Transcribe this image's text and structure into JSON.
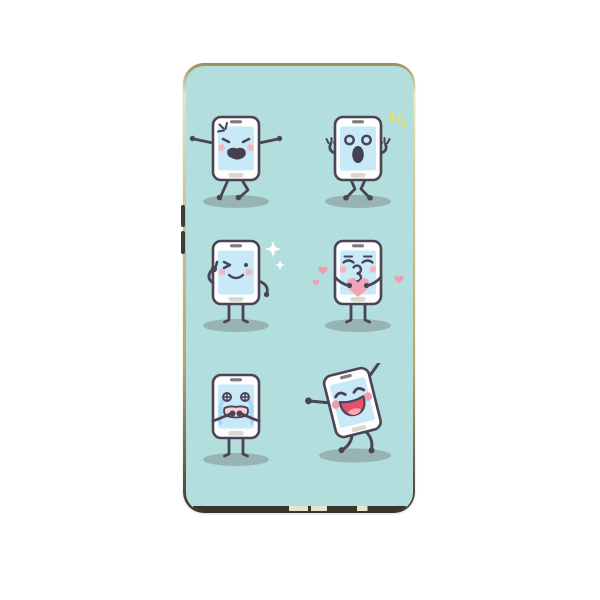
{
  "product": {
    "type": "phone-case",
    "description": "Phone case product photo: gold metal frame, teal back printed with six cartoon smartphone emoji characters in a 2x3 grid",
    "pattern_grid": "2 columns x 3 rows"
  },
  "colors": {
    "background": "#ffffff",
    "case_teal": "#b2dede",
    "outline": "#4a4454",
    "body": "#fdfdfd",
    "screen": "#c7e9f8",
    "speaker": "#7d7d7d",
    "home": "#d9d9d0",
    "cheek": "#f4b6c2",
    "cheek_deep": "#f29cae",
    "mouth": "#453f4e",
    "mouth_red": "#e25069",
    "tongue": "#f7a6b4",
    "heart": "#f2a3b4",
    "heart_small": "#f09cae",
    "tear": "#a9d9f2",
    "sparkle_yellow": "#f0de55",
    "sparkle_white": "#ffffff",
    "shadow": "rgba(110,110,110,0.38)",
    "port_bar": "#3a342c",
    "port_cut": "#e9e2cc",
    "button": "#3f3a33"
  },
  "characters": [
    {
      "id": "angry-phone",
      "grid": "row1-col1",
      "emotion": "angry",
      "features": [
        "anger-mark",
        "slanted-angry-eyes",
        "open-shouting-mouth",
        "blush-cheeks",
        "arms-stretched-out",
        "walking-legs",
        "ground-shadow"
      ]
    },
    {
      "id": "surprised-phone",
      "grid": "row1-col2",
      "emotion": "surprised",
      "features": [
        "yellow-flash-sparkle",
        "round-hollow-eyes",
        "oval-open-mouth",
        "hands-raised",
        "knock-kneed-legs",
        "ground-shadow"
      ]
    },
    {
      "id": "winking-phone",
      "grid": "row2-col1",
      "emotion": "winking",
      "features": [
        "white-diamond-sparkles",
        "wink-eye",
        "dot-eye",
        "smile",
        "thumbs-up-hand",
        "blush-cheeks",
        "ground-shadow"
      ]
    },
    {
      "id": "kissing-phone",
      "grid": "row2-col2",
      "emotion": "kissing",
      "features": [
        "closed-eyes",
        "kiss-mouth",
        "big-pink-heart-held",
        "floating-small-hearts",
        "blush-cheeks",
        "ground-shadow"
      ]
    },
    {
      "id": "crying-phone",
      "grid": "row3-col1",
      "emotion": "crying",
      "features": [
        "cross-circle-eyes",
        "blue-tear-streams",
        "hands-over-mouth",
        "open-pink-mouth",
        "ground-shadow"
      ]
    },
    {
      "id": "dancing-phone",
      "grid": "row3-col2",
      "emotion": "happy-dancing",
      "features": [
        "tilted-pose",
        "arc-smile-eyes",
        "big-laughing-mouth",
        "tongue",
        "raised-fist",
        "blush-cheeks",
        "ground-shadow"
      ]
    }
  ],
  "case_details": {
    "frame_finish": "gold-champagne-metal",
    "side_buttons": 2,
    "bottom_cutouts": 3
  }
}
